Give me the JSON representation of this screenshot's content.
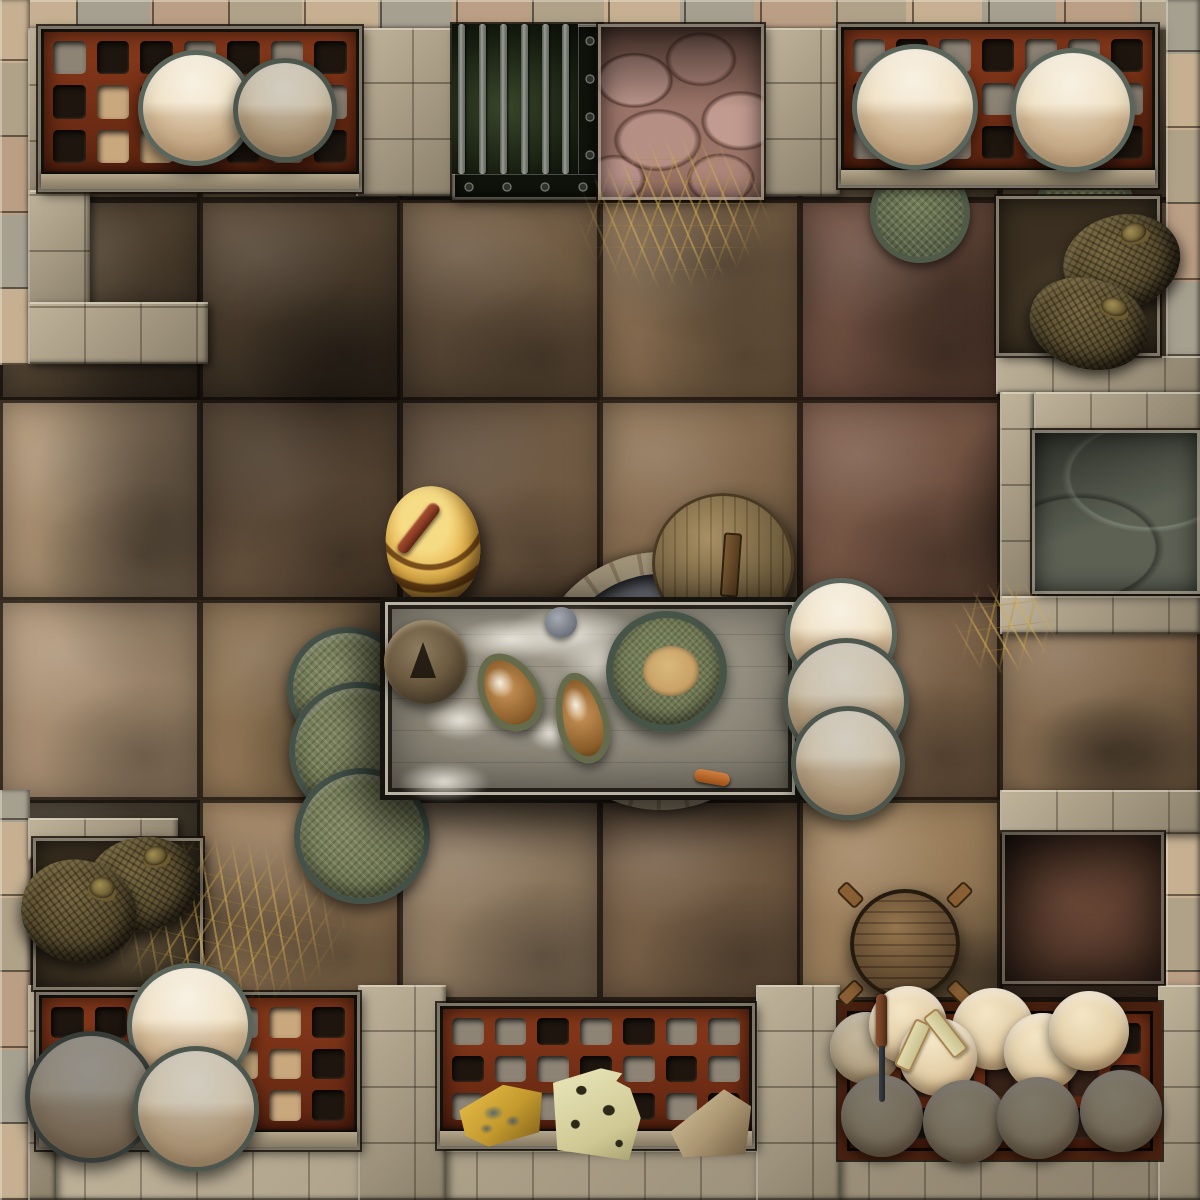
{
  "map": {
    "name": "dungeon-kitchen-store-room-tile",
    "grid_squares": 6,
    "square_px": 200,
    "view": "top-down battle map, stone-flagged room with shelf alcoves of plates and cheese, grain sacks, prep table with dough, grated cell, well, barrel and millstone lid"
  },
  "palette": {
    "floorGap": "#160f07",
    "stoneWall": "#b2a489",
    "stoneBorderA": "#c6b091",
    "stoneBorderB": "#a6a090",
    "stoneBorderC": "#bb9f85",
    "shelfRed": "#8a3a1b",
    "shelfRedDark": "#5e2410",
    "plateCream": "#efe0c2",
    "plateRim": "#5a655b",
    "trayGreen": "#6d7550",
    "trayRim": "#44524a",
    "basketGreen": "#76815a",
    "sackBrown": "#5c4f30",
    "wheelCream": "#f4e6c6",
    "cheeseBlue": "#e8c04a",
    "cheeseSwiss": "#ece8bc",
    "swissHole": "#2e2818",
    "cheeseTan": "#d8c9a0",
    "tableWood": "#958f7e",
    "tableFrame": "#b8b2a4",
    "domeBronze": "#6b5a40",
    "breadRim": "#666b4c",
    "breadCrust": "#c9955a",
    "bowlGrain": "#c9a266",
    "barrelGold": "#f7dc86",
    "stickRust": "#8a3c24",
    "diskWood": "#8d7347",
    "grateGreen": "#39462a",
    "barSteel": "#9a9d94",
    "cobblePink": "#9b7468",
    "alcoveDark": "#3a2f20",
    "nicheStone": "#5c6154",
    "nicheDarkRed": "#2e1810",
    "knifeSteel": "#23272c",
    "knifeWood": "#6b3c22"
  },
  "floor": {
    "tiles": [
      "#6a5740",
      "#6a5740",
      "#2e2c1e",
      "#8d6e62",
      "#6a5740",
      "#5d4c38",
      "#4f3f2c",
      "#5d4933",
      "#7b6145",
      "#8a6c4c",
      "#6e4b3a",
      "#6e5a3e",
      "#b29573",
      "#84674a",
      "#8a6c4e",
      "#8f7150",
      "#7b5642",
      "#565a4c",
      "#b49777",
      "#9f7f58",
      "#8d6f4f",
      "#8a6c4c",
      "#85674a",
      "#8d7050",
      "#3f3526",
      "#a4825c",
      "#9a8164",
      "#7c6045",
      "#a7865d",
      "#4a3425",
      "#5d4c38",
      "#5d4c38",
      "#5d4c38",
      "#5d4c38",
      "#5d4c38",
      "#5d4c38"
    ]
  },
  "shadows": [
    {
      "x": 20,
      "y": 180,
      "w": 620,
      "h": 440,
      "o": 0.5
    },
    {
      "x": 190,
      "y": 520,
      "w": 380,
      "h": 320,
      "o": 0.35
    },
    {
      "x": 30,
      "y": 330,
      "w": 260,
      "h": 380,
      "o": 0.35
    },
    {
      "x": 590,
      "y": 180,
      "w": 270,
      "h": 170,
      "o": 0.35
    },
    {
      "x": 830,
      "y": 185,
      "w": 250,
      "h": 200,
      "o": 0.3
    },
    {
      "x": 945,
      "y": 415,
      "w": 130,
      "h": 210,
      "o": 0.4
    },
    {
      "x": 40,
      "y": 815,
      "w": 330,
      "h": 210,
      "o": 0.4
    },
    {
      "x": 340,
      "y": 555,
      "w": 520,
      "h": 310,
      "o": 0.32
    },
    {
      "x": 825,
      "y": 925,
      "w": 370,
      "h": 100,
      "o": 0.4
    },
    {
      "x": 1015,
      "y": 695,
      "w": 185,
      "h": 115,
      "o": 0.35
    }
  ],
  "walls": [
    {
      "name": "border-top",
      "x": 0,
      "y": 0,
      "w": 1200,
      "h": 30,
      "kind": "border"
    },
    {
      "name": "border-bottom",
      "x": 0,
      "y": 1166,
      "w": 1200,
      "h": 34,
      "kind": "border"
    },
    {
      "name": "border-left-upper",
      "x": 0,
      "y": 0,
      "w": 30,
      "h": 365,
      "kind": "border"
    },
    {
      "name": "border-left-lower",
      "x": 0,
      "y": 790,
      "w": 30,
      "h": 410,
      "kind": "border"
    },
    {
      "name": "border-right-upper",
      "x": 1166,
      "y": 0,
      "w": 34,
      "h": 432,
      "kind": "border"
    },
    {
      "name": "border-right-lower",
      "x": 1166,
      "y": 790,
      "w": 34,
      "h": 410,
      "kind": "border"
    },
    {
      "name": "wall-top-left-vertical",
      "x": 28,
      "y": 28,
      "w": 34,
      "h": 170,
      "kind": "wall"
    },
    {
      "name": "wall-left-upper-block",
      "x": 28,
      "y": 190,
      "w": 62,
      "h": 118,
      "kind": "wall"
    },
    {
      "name": "wall-top-left-return",
      "x": 28,
      "y": 302,
      "w": 180,
      "h": 62,
      "kind": "wall"
    },
    {
      "name": "wall-top-pier-west",
      "x": 356,
      "y": 28,
      "w": 104,
      "h": 168,
      "kind": "wall"
    },
    {
      "name": "wall-top-pier-east",
      "x": 764,
      "y": 28,
      "w": 76,
      "h": 168,
      "kind": "wall"
    },
    {
      "name": "wall-below-east-sacks",
      "x": 996,
      "y": 356,
      "w": 204,
      "h": 38,
      "kind": "wall"
    },
    {
      "name": "wall-right-mid-vertical",
      "x": 1000,
      "y": 392,
      "w": 34,
      "h": 206,
      "kind": "wall"
    },
    {
      "name": "wall-above-stone-niche",
      "x": 1034,
      "y": 392,
      "w": 166,
      "h": 40,
      "kind": "wall"
    },
    {
      "name": "wall-below-stone-niche",
      "x": 1000,
      "y": 596,
      "w": 200,
      "h": 38,
      "kind": "wall"
    },
    {
      "name": "wall-southeast-corner-band",
      "x": 1000,
      "y": 790,
      "w": 200,
      "h": 44,
      "kind": "wall"
    },
    {
      "name": "wall-bottom-left-corner-band",
      "x": 28,
      "y": 818,
      "w": 150,
      "h": 42,
      "kind": "wall"
    },
    {
      "name": "wall-bottom-strip",
      "x": 28,
      "y": 1150,
      "w": 1144,
      "h": 50,
      "kind": "wall"
    },
    {
      "name": "wall-bottom-left-block",
      "x": 28,
      "y": 985,
      "w": 28,
      "h": 215,
      "kind": "wall"
    },
    {
      "name": "wall-bottom-pier-west",
      "x": 358,
      "y": 985,
      "w": 88,
      "h": 215,
      "kind": "wall"
    },
    {
      "name": "wall-bottom-pier-east",
      "x": 756,
      "y": 985,
      "w": 84,
      "h": 215,
      "kind": "wall"
    },
    {
      "name": "wall-bottom-right-block",
      "x": 1158,
      "y": 985,
      "w": 42,
      "h": 215,
      "kind": "wall"
    }
  ],
  "lattices": {
    "tl": {
      "cols": 7,
      "rows": 3,
      "holes": [
        "s",
        "d",
        "d",
        "s",
        "d",
        "s",
        "d",
        "d",
        "b",
        "d",
        "d",
        "s",
        "d",
        "s",
        "d",
        "b",
        "b",
        "d",
        "d",
        "s",
        "d"
      ]
    },
    "tr": {
      "cols": 7,
      "rows": 3,
      "holes": [
        "s",
        "d",
        "s",
        "d",
        "s",
        "s",
        "d",
        "d",
        "s",
        "d",
        "s",
        "d",
        "s",
        "s",
        "s",
        "d",
        "s",
        "d",
        "s",
        "d",
        "d"
      ]
    },
    "bl": {
      "cols": 7,
      "rows": 3,
      "holes": [
        "d",
        "d",
        "s",
        "d",
        "s",
        "b",
        "d",
        "d",
        "s",
        "d",
        "d",
        "b",
        "b",
        "d",
        "d",
        "d",
        "s",
        "d",
        "b",
        "b",
        "d"
      ]
    },
    "bm": {
      "cols": 7,
      "rows": 3,
      "holes": [
        "s",
        "s",
        "d",
        "s",
        "d",
        "s",
        "s",
        "d",
        "s",
        "s",
        "d",
        "s",
        "d",
        "s",
        "s",
        "d",
        "s",
        "s",
        "d",
        "s",
        "d"
      ]
    },
    "br": {
      "cols": 7,
      "rows": 3,
      "holes": [
        "e",
        "d",
        "e",
        "d",
        "e",
        "e",
        "d",
        "d",
        "e",
        "d",
        "e",
        "d",
        "e",
        "e",
        "e",
        "d",
        "e",
        "e",
        "d",
        "e",
        "d"
      ]
    }
  },
  "hole_colors": {
    "d": "#1d150e",
    "s": "#8d8476",
    "b": "#c9a87e",
    "e": "#3a241a"
  },
  "grate": {
    "bar_count": 6,
    "bar_xs": [
      6,
      27,
      48,
      69,
      90,
      110
    ]
  },
  "plates": [
    {
      "group": "top-left-shelf",
      "cx": 196,
      "cy": 108,
      "r": 58,
      "tone": "bright"
    },
    {
      "group": "top-left-shelf",
      "cx": 285,
      "cy": 110,
      "r": 52,
      "tone": "mid"
    },
    {
      "group": "top-right-shelf",
      "cx": 915,
      "cy": 107,
      "r": 63,
      "tone": "bright"
    },
    {
      "group": "top-right-shelf",
      "cx": 1073,
      "cy": 110,
      "r": 62,
      "tone": "bright"
    },
    {
      "group": "table-right-stack",
      "cx": 841,
      "cy": 634,
      "r": 56,
      "tone": "bright"
    },
    {
      "group": "table-right-stack",
      "cx": 846,
      "cy": 701,
      "r": 63,
      "tone": "mid"
    },
    {
      "group": "table-right-stack",
      "cx": 848,
      "cy": 763,
      "r": 57,
      "tone": "mid"
    },
    {
      "group": "bottom-left-shelf",
      "cx": 190,
      "cy": 1026,
      "r": 63,
      "tone": "bright"
    },
    {
      "group": "bottom-left-shelf",
      "cx": 91,
      "cy": 1097,
      "r": 66,
      "tone": "dark"
    },
    {
      "group": "bottom-left-shelf",
      "cx": 196,
      "cy": 1109,
      "r": 63,
      "tone": "mid"
    }
  ],
  "green_trays": [
    {
      "cx": 348,
      "cy": 688,
      "r": 61
    },
    {
      "cx": 358,
      "cy": 751,
      "r": 69
    },
    {
      "cx": 362,
      "cy": 836,
      "r": 68
    }
  ],
  "baskets": [
    {
      "cx": 920,
      "cy": 213,
      "r": 50
    },
    {
      "cx": 1085,
      "cy": 215,
      "r": 52
    }
  ],
  "sacks": [
    {
      "group": "east-niche",
      "cx": 1122,
      "cy": 262,
      "rx": 59,
      "ry": 47,
      "rot": -18
    },
    {
      "group": "east-niche",
      "cx": 1089,
      "cy": 324,
      "rx": 60,
      "ry": 45,
      "rot": 14
    },
    {
      "group": "west-alcove",
      "cx": 143,
      "cy": 884,
      "rx": 56,
      "ry": 47,
      "rot": -14
    },
    {
      "group": "west-alcove",
      "cx": 79,
      "cy": 911,
      "rx": 58,
      "ry": 51,
      "rot": 8
    }
  ],
  "cheese_wheels": [
    {
      "cx": 866,
      "cy": 1048,
      "r": 36,
      "tone": "dim"
    },
    {
      "cx": 908,
      "cy": 1025,
      "r": 39,
      "tone": "bright"
    },
    {
      "cx": 993,
      "cy": 1029,
      "r": 41,
      "tone": "bright"
    },
    {
      "cx": 1043,
      "cy": 1052,
      "r": 39,
      "tone": "bright"
    },
    {
      "cx": 1089,
      "cy": 1031,
      "r": 40,
      "tone": "bright"
    },
    {
      "cx": 938,
      "cy": 1057,
      "r": 39,
      "tone": "bright"
    },
    {
      "cx": 882,
      "cy": 1116,
      "r": 41,
      "tone": "dark"
    },
    {
      "cx": 965,
      "cy": 1122,
      "r": 42,
      "tone": "dark"
    },
    {
      "cx": 1038,
      "cy": 1118,
      "r": 41,
      "tone": "dark"
    },
    {
      "cx": 1121,
      "cy": 1111,
      "r": 41,
      "tone": "dark"
    }
  ],
  "cheeses": [
    {
      "kind": "blue",
      "x": 460,
      "y": 1085,
      "w": 84,
      "h": 60,
      "rot": -6
    },
    {
      "kind": "swiss",
      "x": 551,
      "y": 1068,
      "w": 90,
      "h": 90,
      "rot": 4
    },
    {
      "kind": "wedge",
      "x": 670,
      "y": 1090,
      "w": 82,
      "h": 66,
      "rot": -3
    }
  ],
  "straw": [
    {
      "x": 575,
      "y": 135,
      "w": 200,
      "h": 155,
      "rot": -8
    },
    {
      "x": 95,
      "y": 835,
      "w": 255,
      "h": 170,
      "rot": 5
    },
    {
      "x": 950,
      "y": 580,
      "w": 110,
      "h": 95,
      "rot": -15
    }
  ],
  "flour": [
    {
      "x": 455,
      "y": 618,
      "w": 110,
      "h": 42
    },
    {
      "x": 505,
      "y": 605,
      "w": 130,
      "h": 58
    },
    {
      "x": 560,
      "y": 640,
      "w": 110,
      "h": 46
    },
    {
      "x": 425,
      "y": 700,
      "w": 70,
      "h": 40
    },
    {
      "x": 528,
      "y": 716,
      "w": 46,
      "h": 34
    },
    {
      "x": 600,
      "y": 660,
      "w": 60,
      "h": 36
    },
    {
      "x": 398,
      "y": 762,
      "w": 92,
      "h": 40
    }
  ]
}
